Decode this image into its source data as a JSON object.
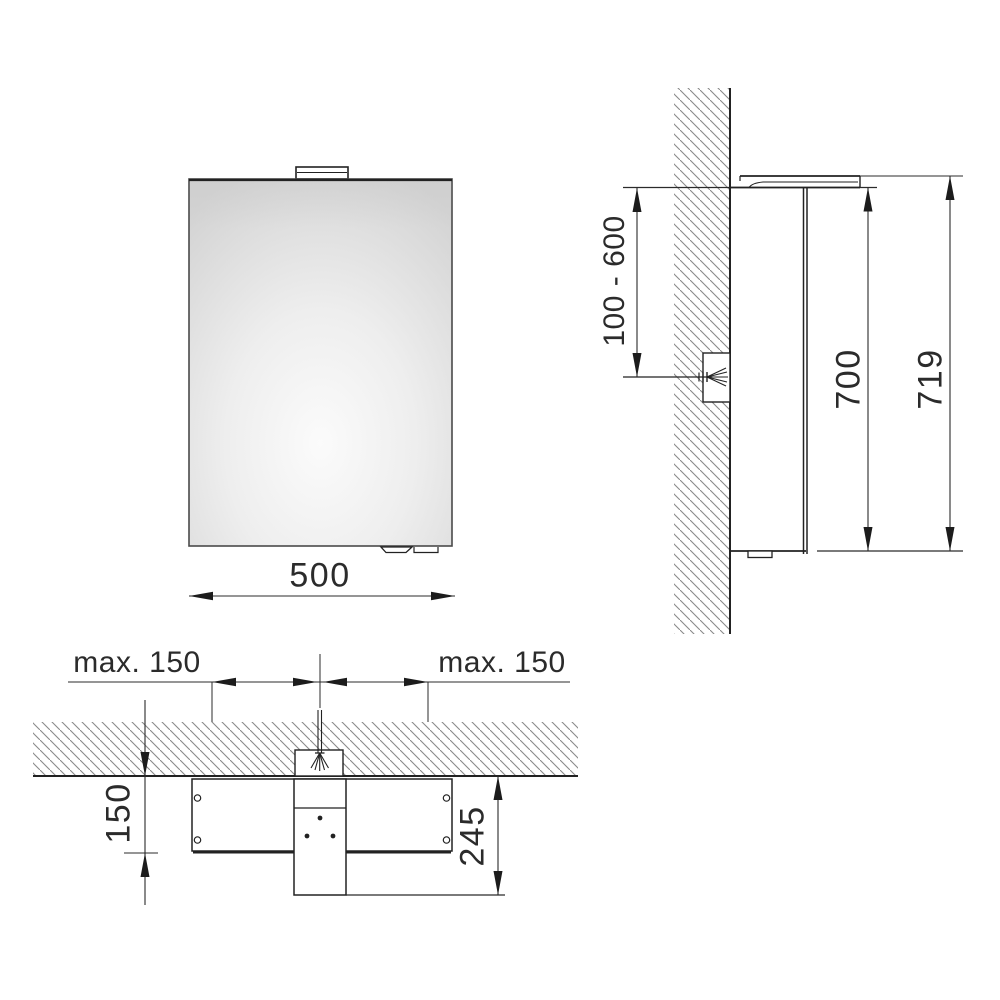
{
  "drawing": {
    "type": "technical-dimension-drawing",
    "subject": "mirror cabinet with top light, wall mounting",
    "views": [
      "front",
      "side",
      "top"
    ]
  },
  "labels": {
    "front_width": "500",
    "side_mount_range": "100 - 600",
    "side_cabinet_height": "700",
    "side_total_height": "719",
    "top_offset_left": "max. 150",
    "top_offset_right": "max. 150",
    "top_depth": "150",
    "top_total_depth": "245"
  },
  "colors": {
    "background": "#ffffff",
    "line": "#2b2b2b",
    "hatch": "#8a8a8a",
    "mirror_light": "#fbfbfb",
    "mirror_dark": "#d3d3d3",
    "text": "#2b2b2b"
  }
}
